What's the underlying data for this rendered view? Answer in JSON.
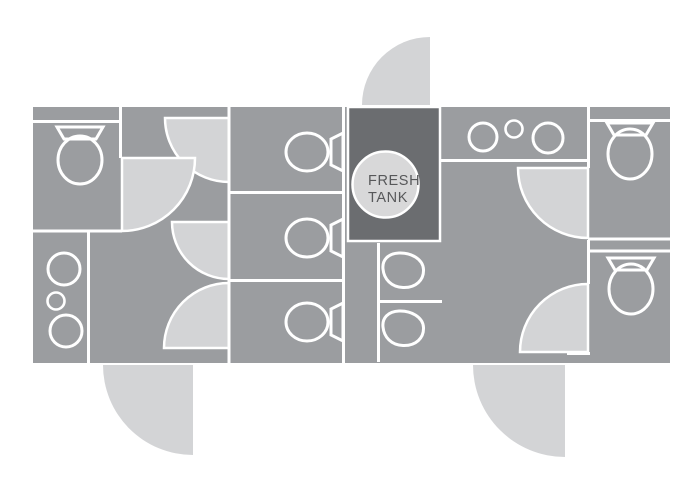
{
  "fresh_tank": {
    "line1": "FRESH",
    "line2": "TANK"
  },
  "colors": {
    "background": "#ffffff",
    "floor": "#9b9da0",
    "door_swing": "#d3d4d6",
    "fresh_tank_fill": "#6b6d70",
    "fresh_tank_circle": "#d8d8d9",
    "label_text": "#57585a",
    "wall_line": "#ffffff"
  },
  "inventory": {
    "diagram_type": "restroom trailer floor plan",
    "toilets": 6,
    "urinals": 2,
    "sinks_large": 4,
    "sinks_small": 2,
    "toilet_stalls_center": 3,
    "interior_door_swings": 6,
    "exterior_door_swings": 3,
    "fresh_tank_label": "FRESH TANK"
  }
}
